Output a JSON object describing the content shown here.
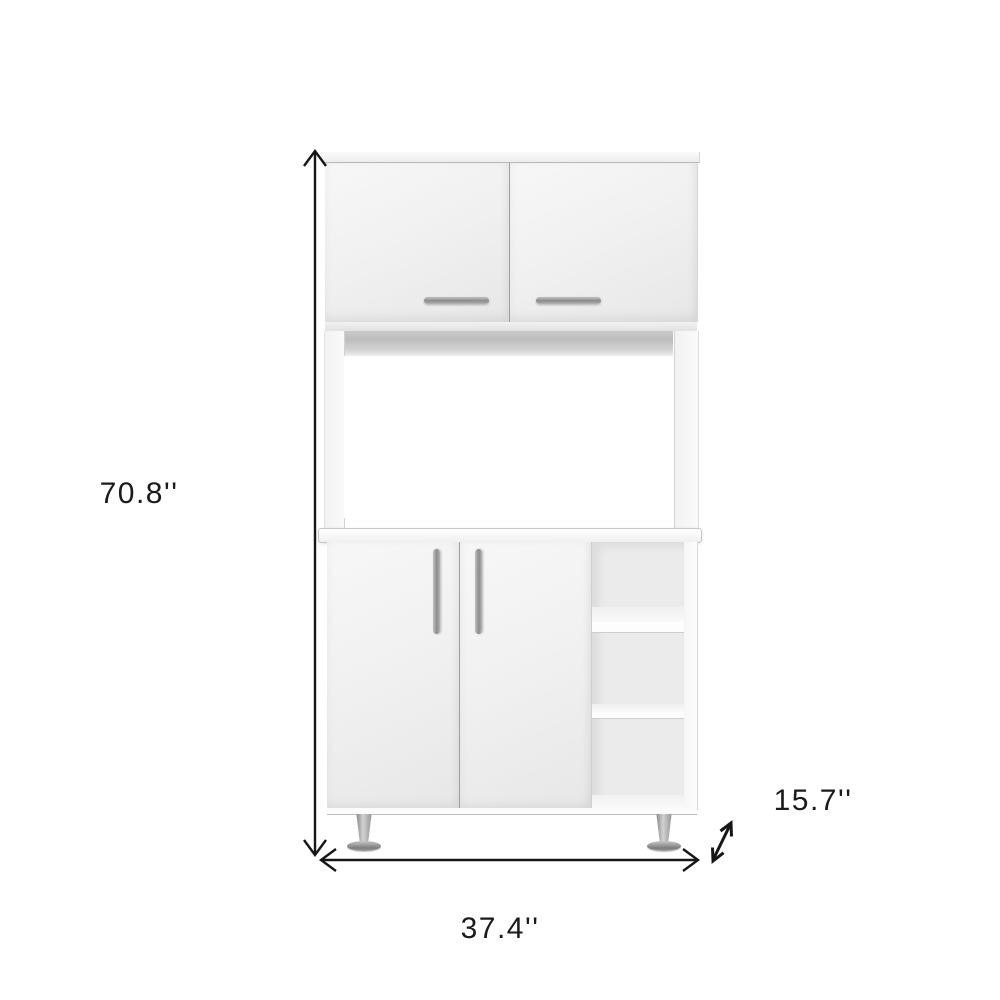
{
  "dimensions": {
    "height": "70.8''",
    "width": "37.4''",
    "depth": "15.7''"
  },
  "colors": {
    "background": "#ffffff",
    "annotation": "#1a1a1a",
    "cabinet_face": "#f0f0f0",
    "shadow_band": "#bdbdbd",
    "handle": "#8b8b8b",
    "leg_chrome": "#9c9c9c"
  }
}
